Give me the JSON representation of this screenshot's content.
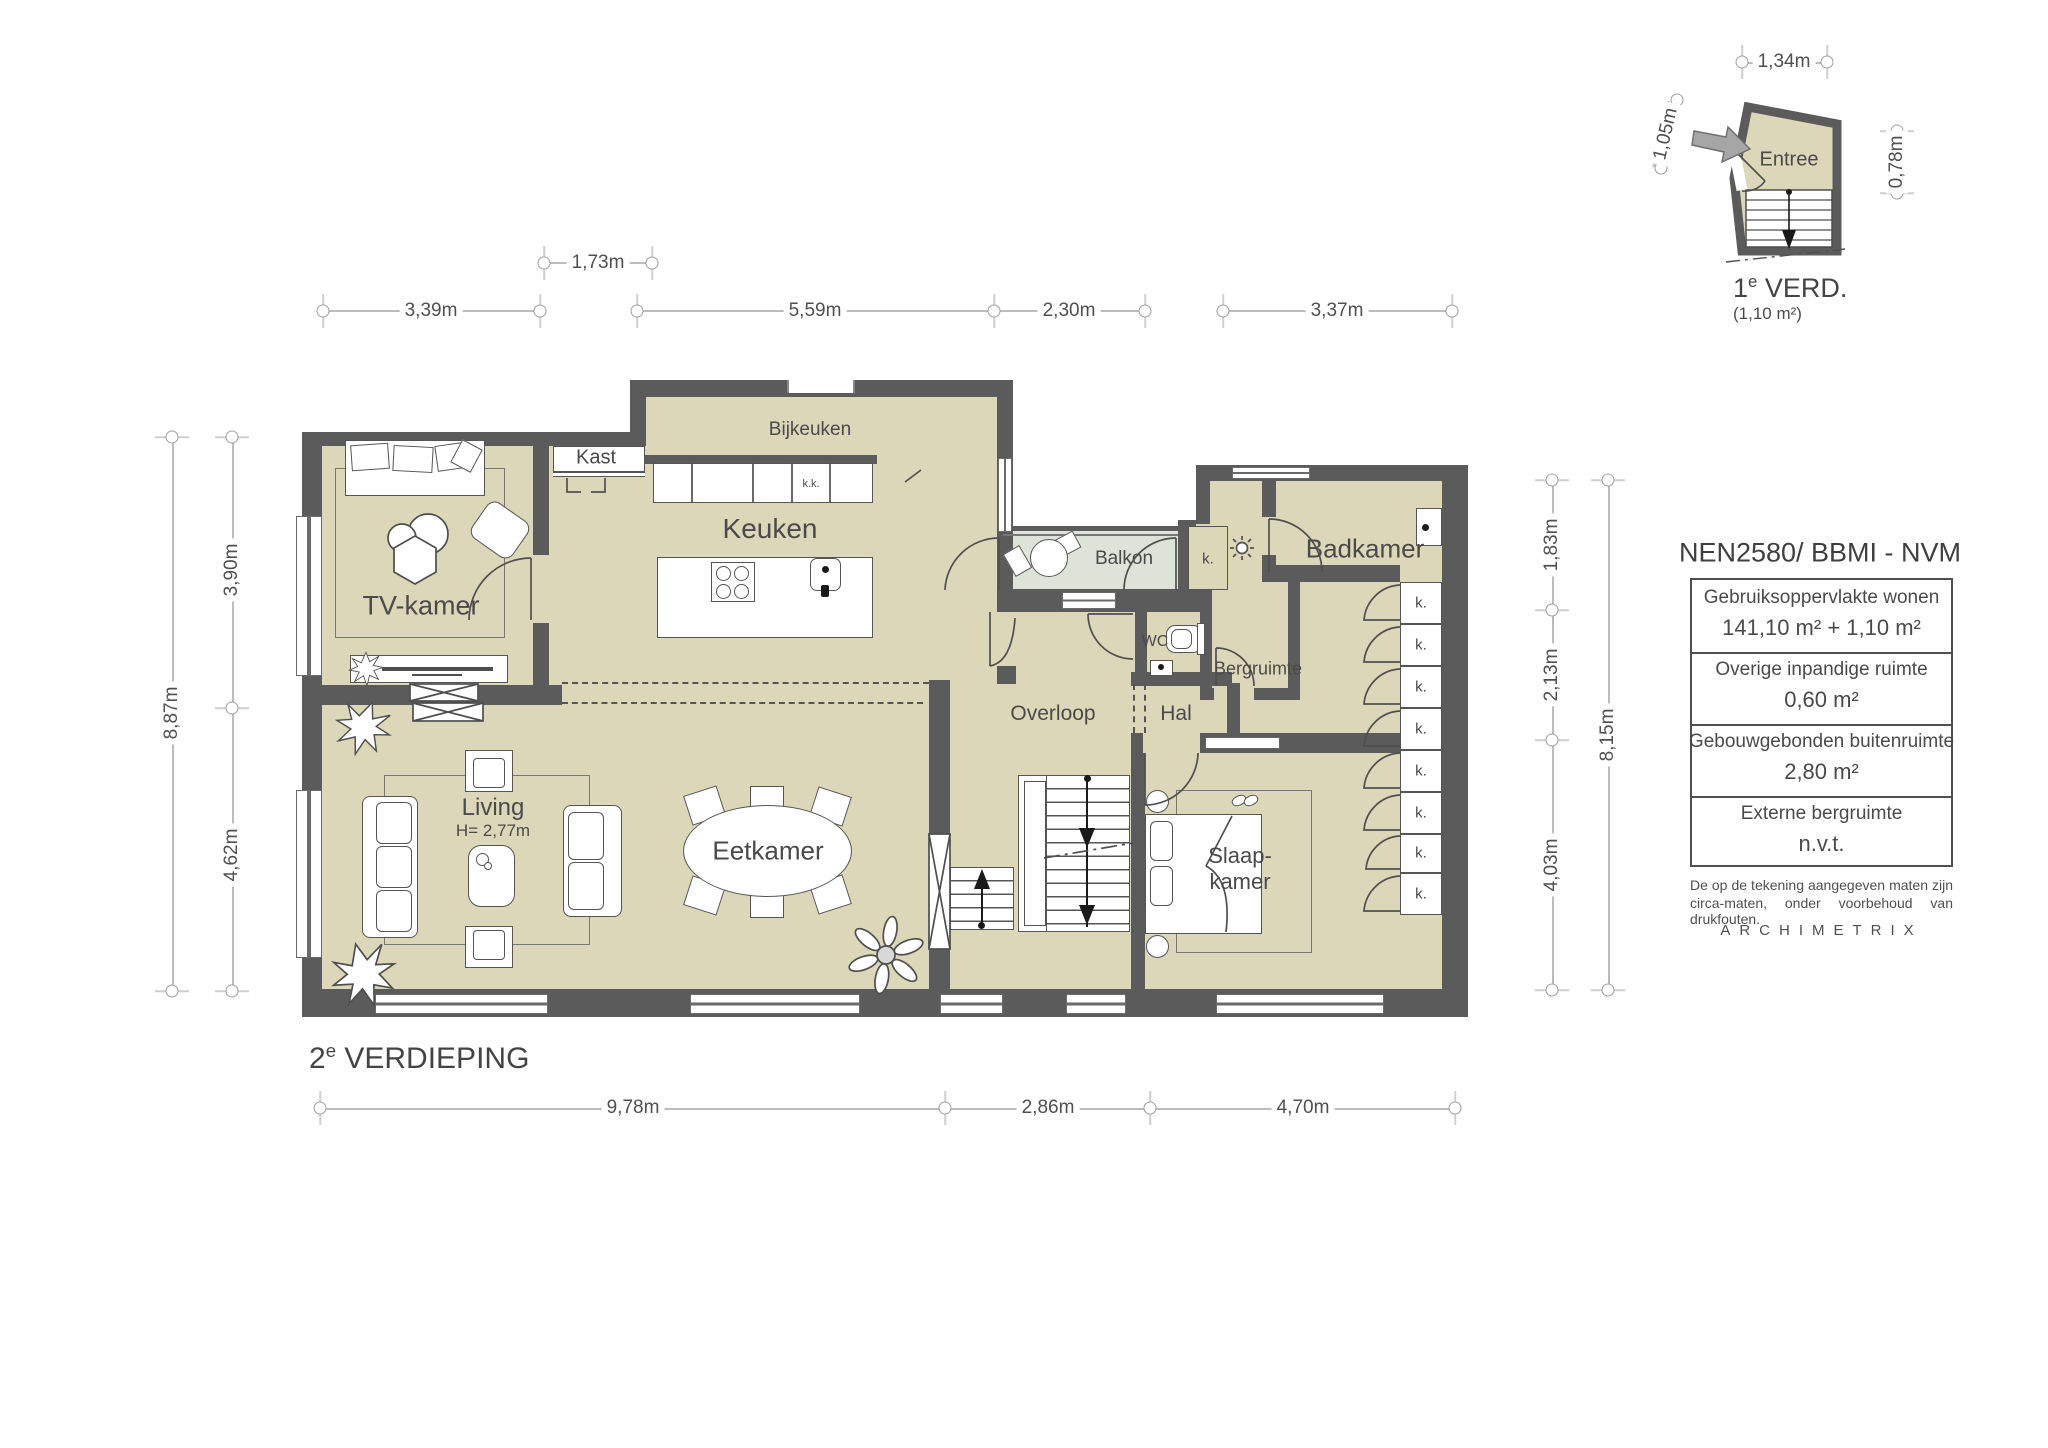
{
  "floor_title": {
    "number": "2",
    "superscript": "e",
    "text": " VERDIEPING"
  },
  "rooms": {
    "tv": "TV-kamer",
    "kast": "Kast",
    "bijkeuken": "Bijkeuken",
    "keuken": "Keuken",
    "kitchen_cabinet": "k.k.",
    "balkon": "Balkon",
    "closet": "k.",
    "badkamer": "Badkamer",
    "wc": "WC",
    "bergruimte": "Bergruimte",
    "overloop": "Overloop",
    "hal": "Hal",
    "living": "Living",
    "living_height": "H= 2,77m",
    "eetkamer": "Eetkamer",
    "slaapkamer_line1": "Slaap-",
    "slaapkamer_line2": "kamer"
  },
  "dims": {
    "top": [
      "3,39m",
      "1,73m",
      "5,59m",
      "2,30m",
      "3,37m"
    ],
    "left": [
      "8,87m",
      "3,90m",
      "4,62m"
    ],
    "right": [
      "1,83m",
      "2,13m",
      "4,03m",
      "8,15m"
    ],
    "bottom": [
      "9,78m",
      "2,86m",
      "4,70m"
    ]
  },
  "inset": {
    "room": "Entree",
    "title_number": "1",
    "title_superscript": "e",
    "title_text": " VERD.",
    "area": "(1,10 m²)",
    "dim_width": "1,34m",
    "dim_left": "1,05m",
    "dim_right": "0,78m"
  },
  "legend": {
    "title": "NEN2580/ BBMI - NVM",
    "rows": [
      {
        "label": "Gebruiksoppervlakte wonen",
        "value": "141,10 m² + 1,10 m²"
      },
      {
        "label": "Overige inpandige ruimte",
        "value": "0,60 m²"
      },
      {
        "label": "Gebouwgebonden buitenruimte",
        "value": "2,80 m²"
      },
      {
        "label": "Externe bergruimte",
        "value": "n.v.t."
      }
    ],
    "note_line1": "De op de tekening aangegeven maten zijn",
    "note_line2": "circa-maten, onder voorbehoud van drukfouten.",
    "brand": "ARCHIMETRIX"
  },
  "colors": {
    "wall": "#5b5b5b",
    "room": "#dcd7b9",
    "balcony": "#dde3d8"
  }
}
